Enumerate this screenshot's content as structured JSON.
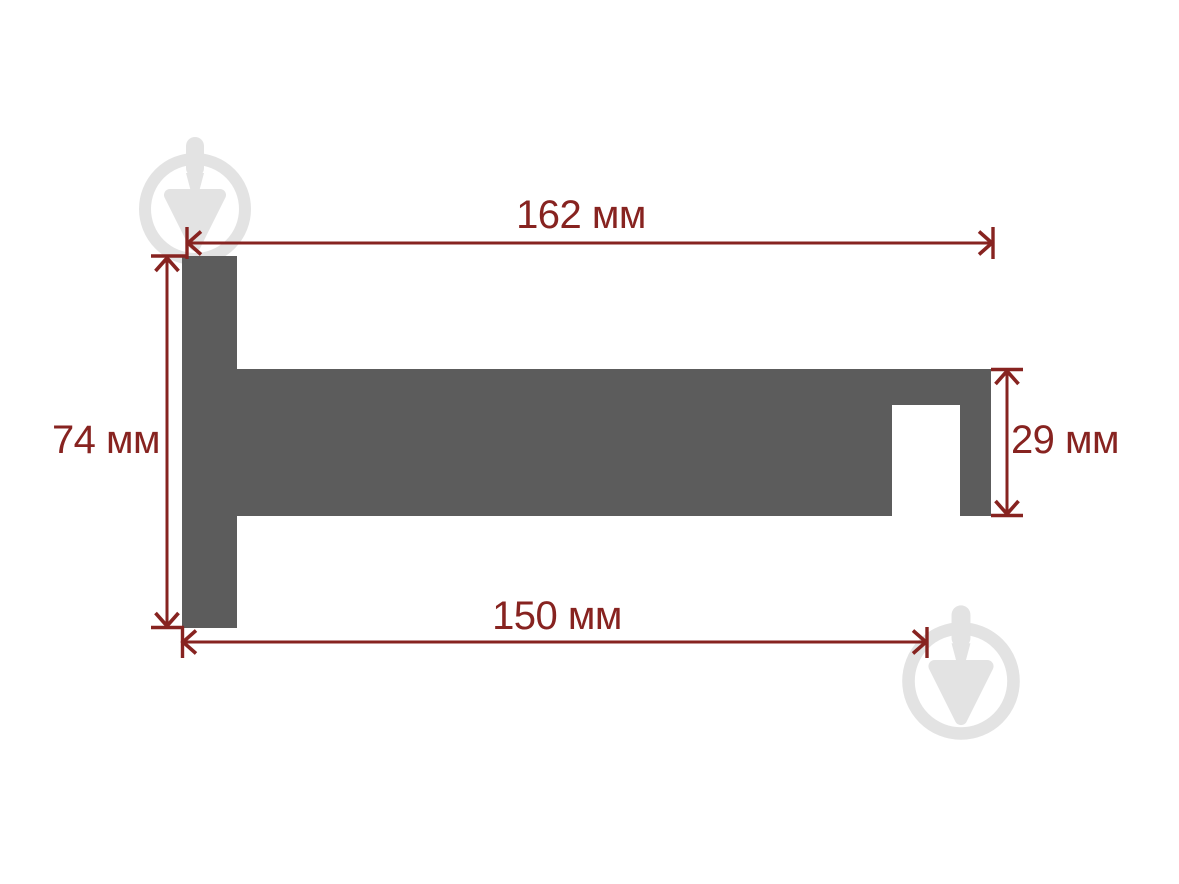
{
  "colors": {
    "background": "#ffffff",
    "shape": "#5c5c5c",
    "dimension": "#872320",
    "watermark": "#e3e3e3"
  },
  "diagram": {
    "type": "dimensioned profile drawing of wall bracket (side view)",
    "unit": "мм",
    "dimensions": {
      "top": {
        "label": "162 мм",
        "value": 162,
        "unit": "мм"
      },
      "left": {
        "label": "74 мм",
        "value": 74,
        "unit": "мм"
      },
      "right": {
        "label": "29 мм",
        "value": 29,
        "unit": "мм"
      },
      "bottom": {
        "label": "150 мм",
        "value": 150,
        "unit": "мм"
      }
    },
    "icons": {
      "watermark": "trowel-in-circle-watermark-icon"
    }
  }
}
